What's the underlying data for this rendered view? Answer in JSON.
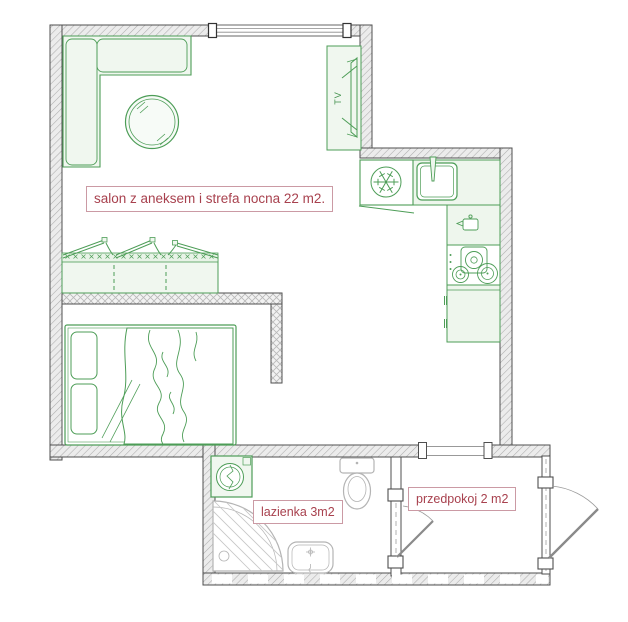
{
  "document": {
    "type": "apartment floor plan"
  },
  "colors": {
    "background": "#ffffff",
    "wall_outline": "#4f4f4f",
    "wall_hatch_fill": "#ececec",
    "wall_hatch_line": "#adadad",
    "partition_hatch_line": "#b8b8b8",
    "furniture_stroke": "#4d9d57",
    "furniture_fill": "#f0f7ef",
    "fixture_stroke": "#b4b4b4",
    "door_stroke": "#8a8a8a",
    "label_text": "#a8414e",
    "label_border": "#cb9aa4"
  },
  "rooms": {
    "salon": {
      "label": "salon z aneksem i strefa nocna 22 m2.",
      "area_m2": 22
    },
    "lazienka": {
      "label": "lazienka 3m2",
      "area_m2": 3
    },
    "przedpokoj": {
      "label": "przedpokoj 2 m2",
      "area_m2": 2
    }
  },
  "tv_label": "TV",
  "fixtures": {
    "salon": [
      "corner-sofa",
      "round-table",
      "tv-cabinet",
      "wardrobe",
      "double-bed"
    ],
    "kitchen_annex": [
      "fridge",
      "kitchen-sink",
      "kitchen-counter",
      "small-appliance-cabinet",
      "gas-stove",
      "kitchen-cabinet"
    ],
    "lazienka": [
      "washing-machine",
      "toilet",
      "corner-shower",
      "washbasin"
    ],
    "openings": [
      "window",
      "passage-opening",
      "bathroom-door",
      "entry-door"
    ]
  }
}
